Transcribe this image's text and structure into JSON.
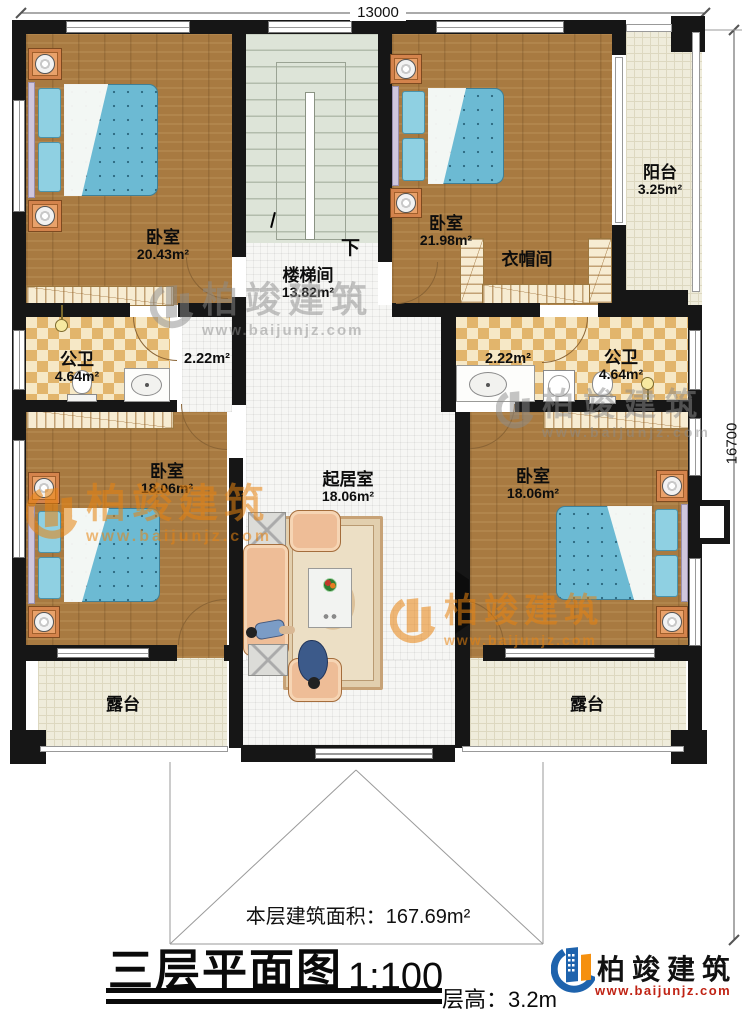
{
  "plan": {
    "dim_top": "13000",
    "dim_right": "16700",
    "stair_down": "下",
    "rooms": {
      "bedroom_tl": {
        "name": "卧室",
        "area": "20.43m²"
      },
      "stairwell": {
        "name": "楼梯间",
        "area": "13.82m²"
      },
      "bedroom_tr": {
        "name": "卧室",
        "area": "21.98m²"
      },
      "cloakroom": {
        "name": "衣帽间"
      },
      "balcony": {
        "name": "阳台",
        "area": "3.25m²"
      },
      "bath_left": {
        "name": "公卫",
        "area": "4.64m²"
      },
      "hall_left": {
        "area": "2.22m²"
      },
      "hall_right": {
        "area": "2.22m²"
      },
      "bath_right": {
        "name": "公卫",
        "area": "4.64m²"
      },
      "bedroom_bl": {
        "name": "卧室",
        "area": "18.06m²"
      },
      "living": {
        "name": "起居室",
        "area": "18.06m²"
      },
      "bedroom_br": {
        "name": "卧室",
        "area": "18.06m²"
      },
      "terrace_left": {
        "name": "露台"
      },
      "terrace_right": {
        "name": "露台"
      }
    }
  },
  "titleblock": {
    "floor_area": "本层建筑面积：167.69m²",
    "title": "三层平面图",
    "scale": "1:100",
    "floor_height": "层高：3.2m"
  },
  "brand": {
    "name": "柏竣建筑",
    "url": "www.baijunjz.com"
  },
  "colors": {
    "wall": "#161616",
    "wood_floor": "#a87a41",
    "mattress_blue": "#6cbad3",
    "checker_tan": "#e2b56c",
    "stair_green": "#dde4d8",
    "terrace_cream": "#efecdb",
    "watermark_orange": "#e8830f",
    "watermark_gray": "#8c8c8c",
    "brand_blue": "#1e63ad",
    "brand_orange": "#f5900f",
    "brand_red": "#c02314"
  }
}
